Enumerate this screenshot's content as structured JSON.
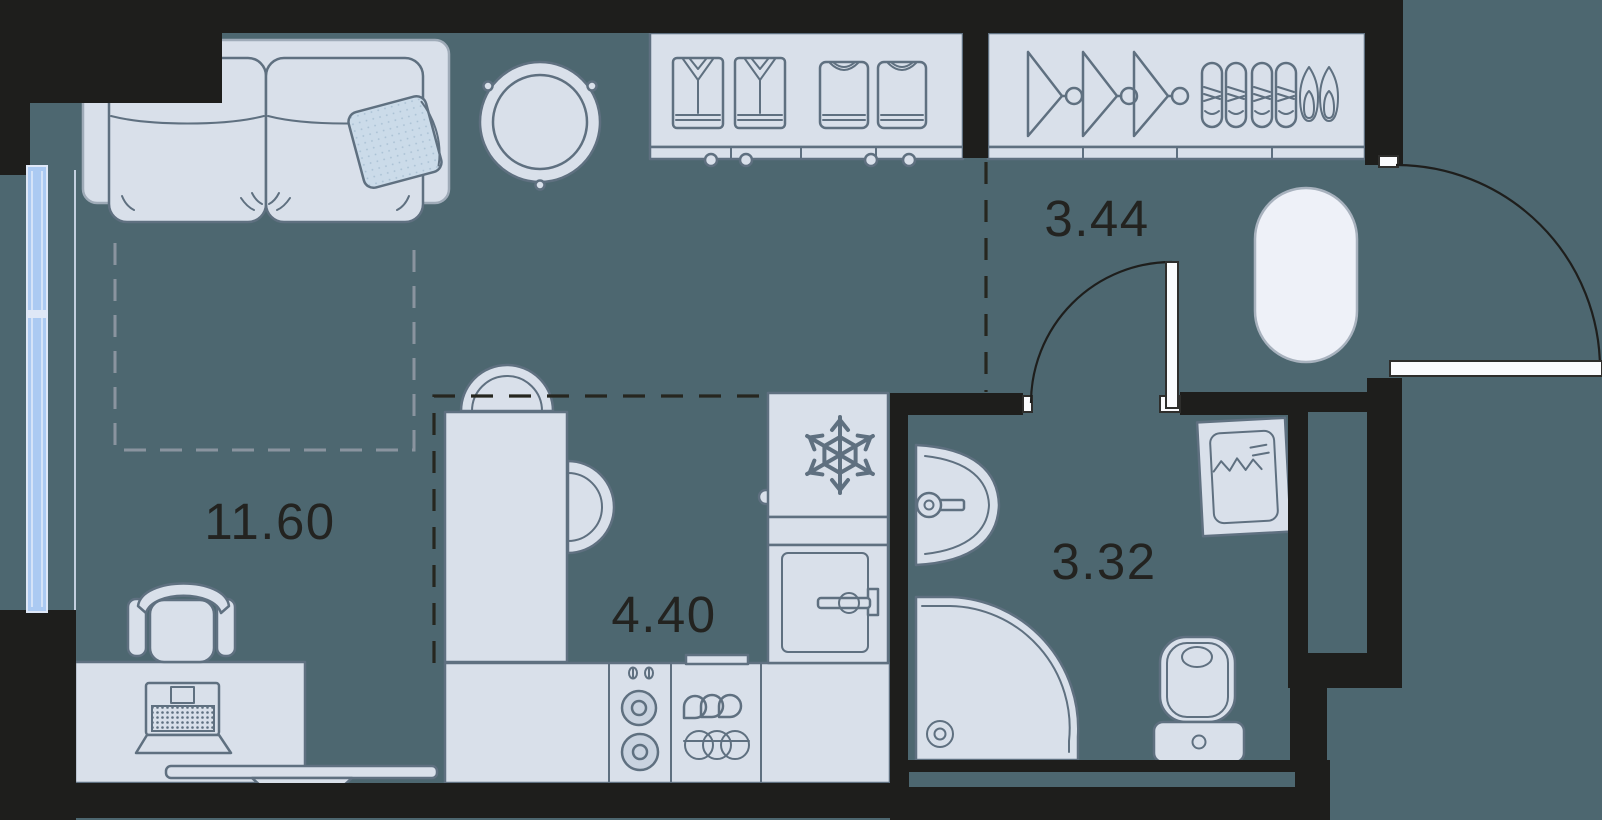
{
  "plan": {
    "title": "studio apartment floor plan",
    "rooms": [
      {
        "name": "living-room",
        "area_label": "11.60"
      },
      {
        "name": "hallway",
        "area_label": "3.44"
      },
      {
        "name": "kitchen",
        "area_label": "4.40"
      },
      {
        "name": "bathroom",
        "area_label": "3.32"
      }
    ],
    "furniture": [
      "sofa",
      "pillow",
      "round-table",
      "dresser-with-folded-clothes",
      "wardrobe-with-hangers-and-shoes",
      "entry-rug",
      "entry-door",
      "bathroom-door",
      "window",
      "desk",
      "office-chair",
      "laptop",
      "tv-console",
      "dining-table",
      "chair",
      "kitchen-counter",
      "hob-two-burners",
      "sink-unit",
      "oven",
      "fridge-snowflake",
      "bathroom-sink",
      "corner-shower",
      "toilet",
      "washing-machine"
    ],
    "colors": {
      "bg": "#4d6770",
      "wall": "#1e1e1c",
      "furniture_fill": "#d9e0ea",
      "furniture_stroke": "#5f7080",
      "soft_stroke": "#9fabb8",
      "window_fill": "#abcaf2",
      "window_frame": "#dfe8f7",
      "rug_fill": "#eef1f8",
      "rug_stroke": "#a8b2be",
      "door_fill": "#fbfcfe",
      "door_arc": "#1e1e1c",
      "dash_gray": "#8a949f",
      "label": "#232320",
      "pillow_fill": "#cbdbe9",
      "pillow_dot": "#a9c0d3",
      "burner_fill": "#c9d3e0"
    }
  }
}
